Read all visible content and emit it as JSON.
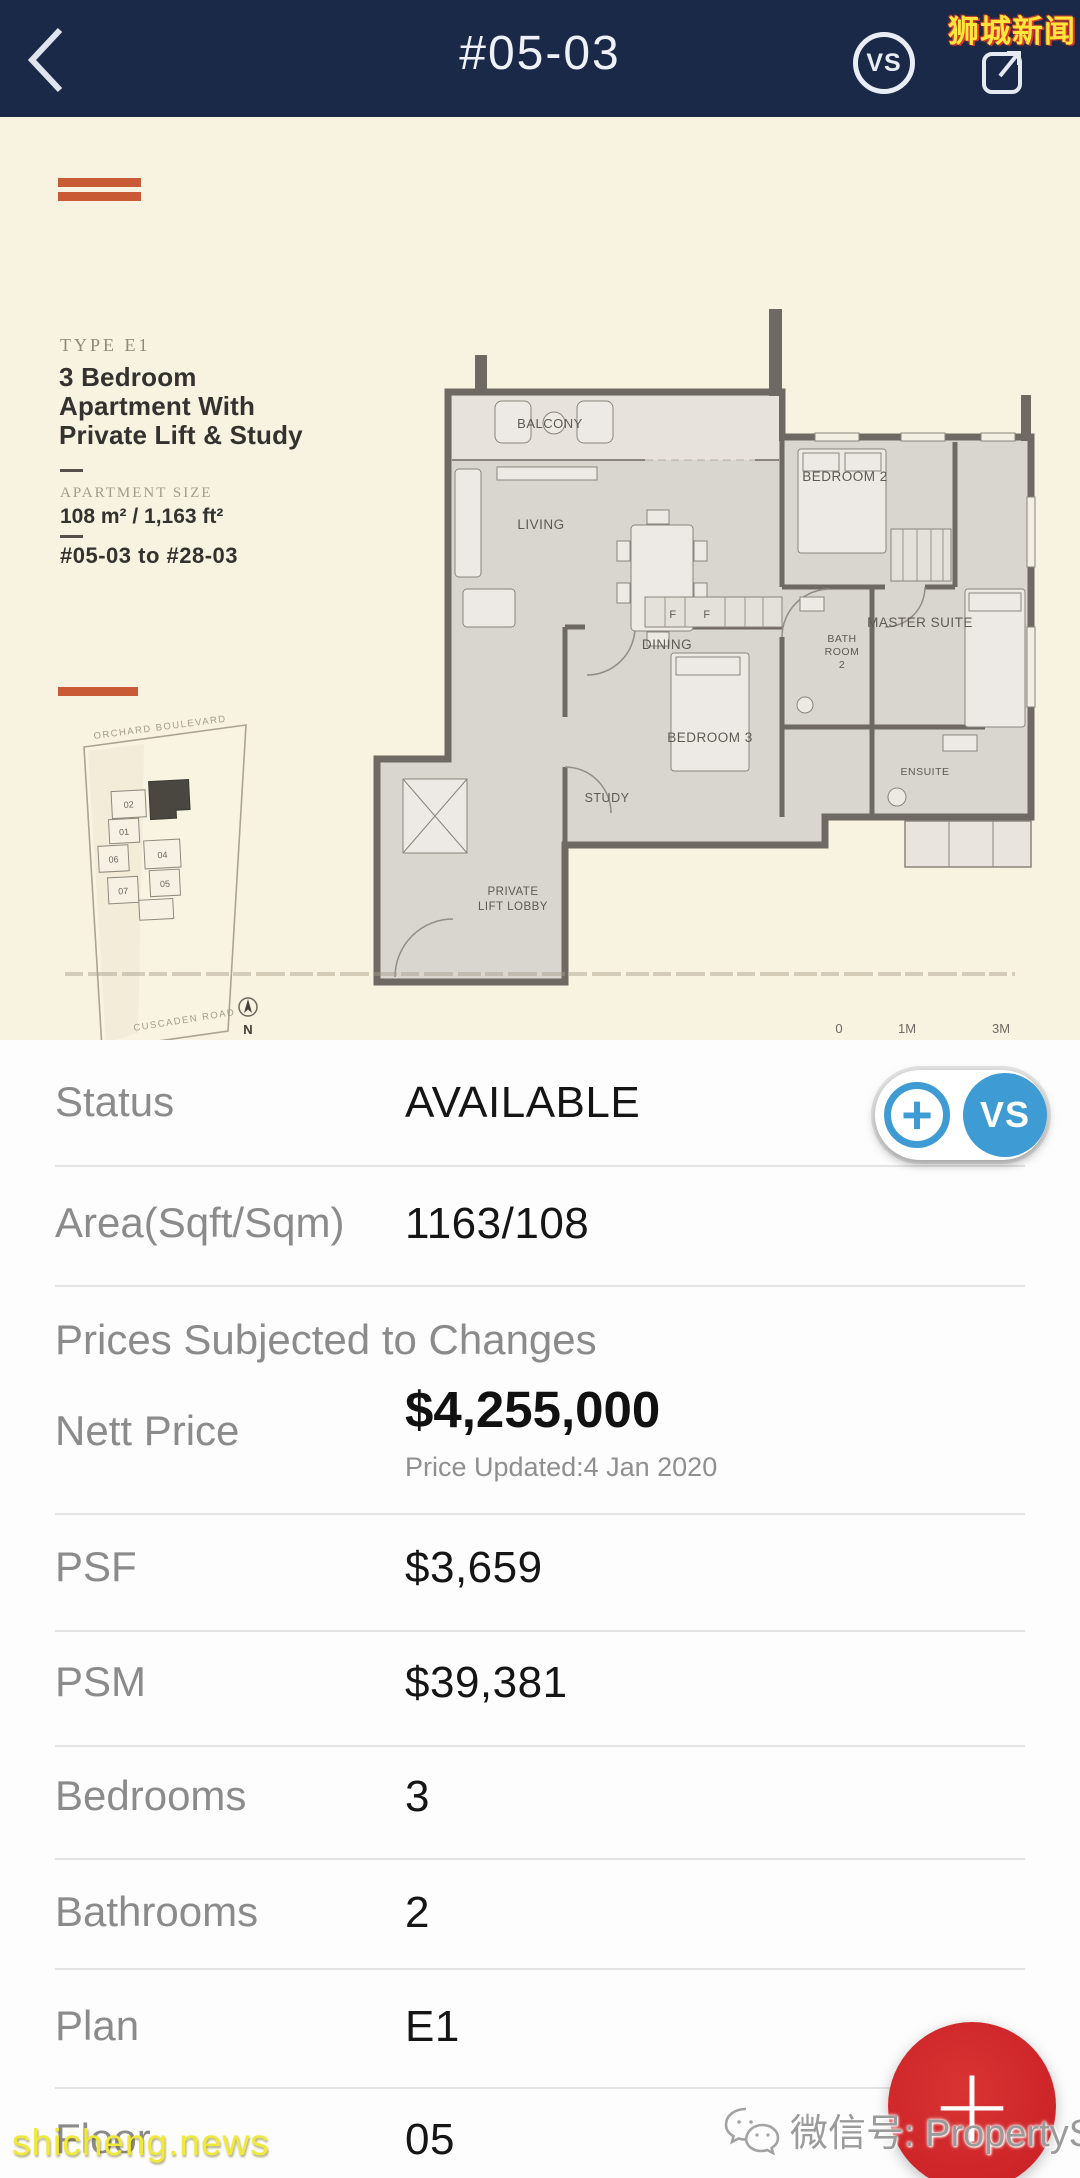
{
  "header": {
    "title": "#05-03",
    "vs_label": "VS",
    "watermark": "狮城新闻"
  },
  "floorplan": {
    "type_label": "TYPE E1",
    "title_lines": [
      "3 Bedroom",
      "Apartment With",
      "Private Lift & Study"
    ],
    "size_label": "APARTMENT SIZE",
    "size_value": "108 m² / 1,163 ft²",
    "unit_range": "#05-03 to #28-03",
    "rooms": {
      "balcony": "BALCONY",
      "living": "LIVING",
      "dining": "DINING",
      "bedroom2": "BEDROOM 2",
      "master": "MASTER SUITE",
      "bath_l1": "BATH",
      "bath_l2": "ROOM",
      "bath_l3": "2",
      "bedroom3": "BEDROOM 3",
      "study": "STUDY",
      "lift_l1": "PRIVATE",
      "lift_l2": "LIFT LOBBY",
      "ensuite": "ENSUITE",
      "f_left": "F",
      "f_right": "F"
    },
    "scale": {
      "zero": "0",
      "one": "1M",
      "three": "3M"
    },
    "sitemap": {
      "road_top": "ORCHARD BOULEVARD",
      "road_bottom": "CUSCADEN ROAD",
      "north": "N",
      "units": [
        "02",
        "01",
        "06",
        "04",
        "05",
        "07"
      ]
    }
  },
  "details": {
    "price_notice": "Prices Subjected to Changes",
    "rows": [
      {
        "label": "Status",
        "value": "AVAILABLE"
      },
      {
        "label": "Area(Sqft/Sqm)",
        "value": "1163/108"
      },
      {
        "label": "Nett Price",
        "value": "$4,255,000",
        "note": "Price Updated:4 Jan 2020"
      },
      {
        "label": "PSF",
        "value": "$3,659"
      },
      {
        "label": "PSM",
        "value": "$39,381"
      },
      {
        "label": "Bedrooms",
        "value": "3"
      },
      {
        "label": "Bathrooms",
        "value": "2"
      },
      {
        "label": "Plan",
        "value": "E1"
      },
      {
        "label": "Floor",
        "value": "05"
      }
    ],
    "vs_button": {
      "plus": "+",
      "vs": "VS"
    }
  },
  "footer": {
    "fab_plus": "+",
    "wechat_label": "微信号: PropertySGSG",
    "site_watermark": "shicheng.news"
  },
  "colors": {
    "header_bg": "#1a2947",
    "accent_blue": "#3e9bd4",
    "fab_red": "#d32a2c",
    "plan_bg": "#f8f2e0",
    "brand_orange": "#c85a36",
    "watermark_yellow": "#ffe63a"
  }
}
